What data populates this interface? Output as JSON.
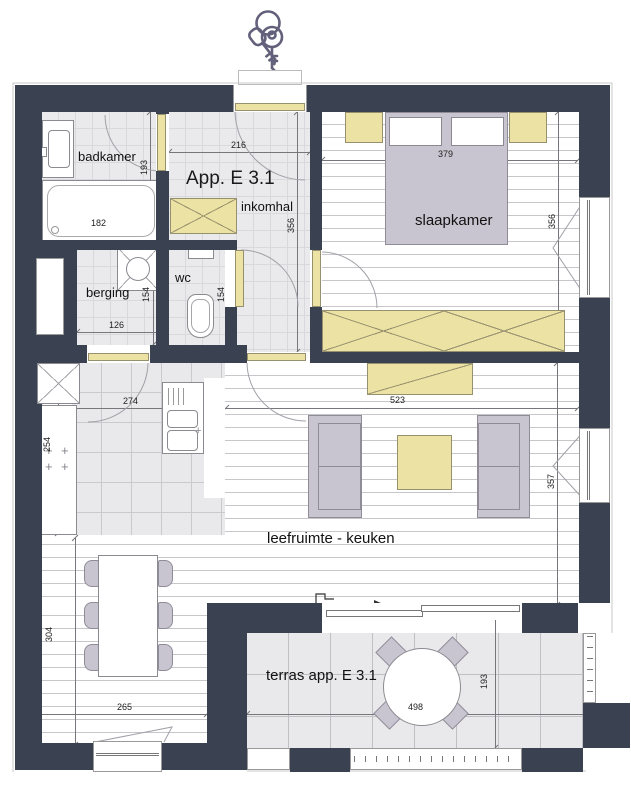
{
  "plan": {
    "apartment_title": "App. E 3.1",
    "rooms": {
      "badkamer": "badkamer",
      "inkomhal": "inkomhal",
      "berging": "berging",
      "wc": "wc",
      "slaapkamer": "slaapkamer",
      "leefruimte": "leefruimte - keuken",
      "terras": "terras app. E 3.1"
    },
    "dimensions_cm": {
      "inkomhal_width": "216",
      "inkomhal_depth": "356",
      "badkamer_depth": "193",
      "bad_width": "182",
      "bed_zone_width": "379",
      "slaapkamer_depth": "356",
      "berging_width": "126",
      "berging_depth": "154",
      "wc_depth": "154",
      "keuken_width": "274",
      "leefruimte_width": "523",
      "werkblad_length": "254",
      "leefruimte_depth": "357",
      "eethoek_depth": "304",
      "eethoek_width": "265",
      "terras_width": "498",
      "terras_depth": "193"
    },
    "colors": {
      "wall": "#3a4150",
      "door_accent": "#ece2a3",
      "furniture_gray": "#c9c5d0"
    },
    "icons": {
      "keys": "keys-icon"
    }
  }
}
